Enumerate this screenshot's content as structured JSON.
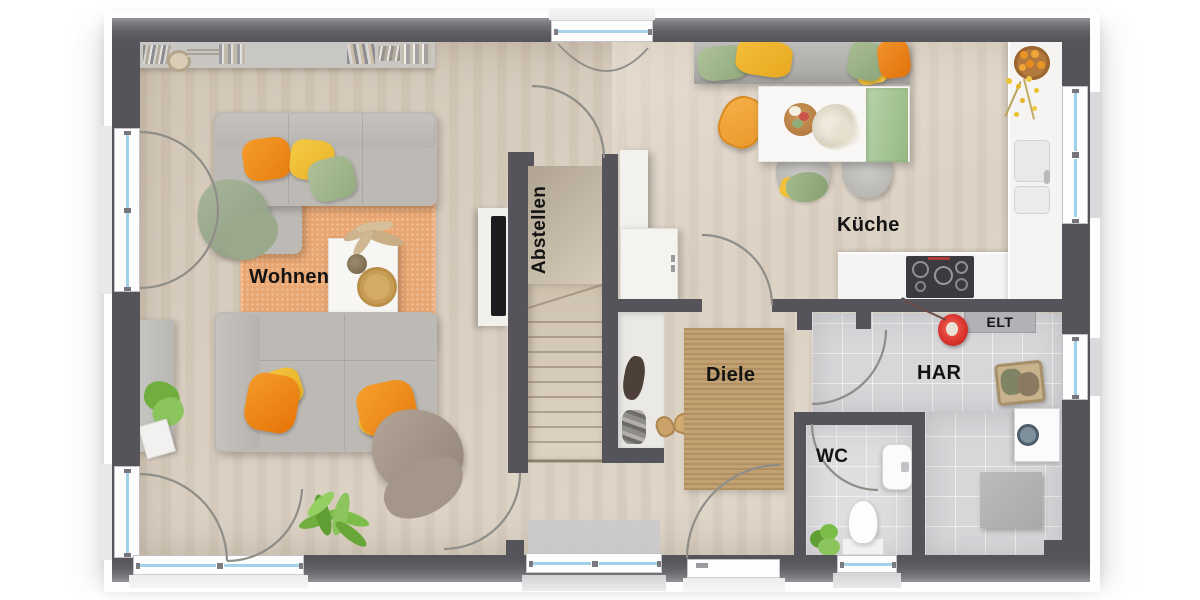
{
  "floorplan": {
    "rooms": {
      "wohnen": {
        "label": "Wohnen"
      },
      "abstellen": {
        "label": "Abstellen"
      },
      "kueche": {
        "label": "Küche"
      },
      "diele": {
        "label": "Diele"
      },
      "har": {
        "label": "HAR"
      },
      "wc": {
        "label": "WC"
      }
    },
    "annotations": {
      "elt": {
        "label": "ELT"
      }
    },
    "palette": {
      "wall": "#54545a",
      "floor_wood": "#d7ccbe",
      "floor_tile": "#d7d7d9",
      "rug_living_orange": "#e9a671",
      "rug_hall_jute": "#c2a272",
      "window_glass_blue": "#9ed0ea",
      "sofa_gray": "#bcb9b4",
      "pillow_orange": "#f0921e",
      "pillow_yellow": "#f3c338",
      "pillow_green": "#a4bb8e",
      "vacuum_red": "#d7322c",
      "plant_green": "#6fae3f",
      "counter_white": "#f5f4f2",
      "cooktop_dark": "#3b3b3f"
    }
  }
}
